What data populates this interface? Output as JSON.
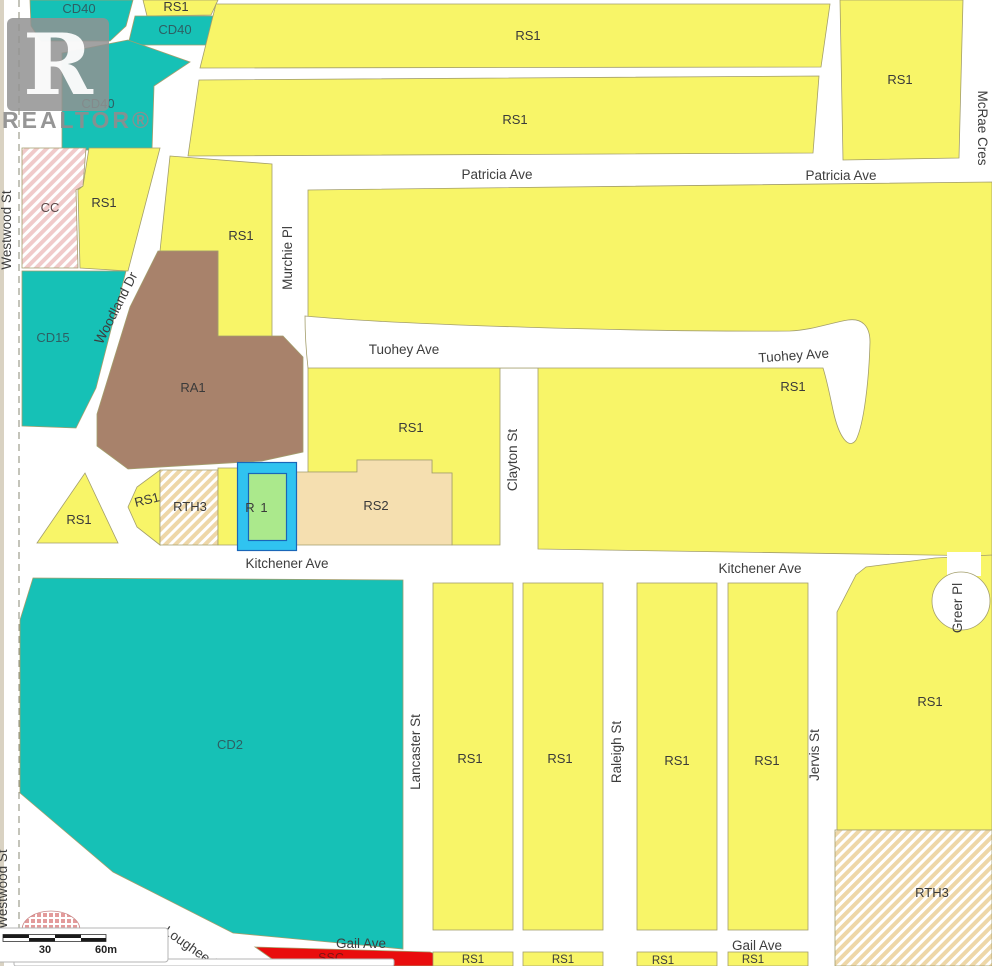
{
  "watermark": {
    "text": "REALTOR®",
    "letter": "R"
  },
  "map": {
    "zone_labels": [
      {
        "text": "CD40"
      },
      {
        "text": "RS1"
      },
      {
        "text": "CD40"
      },
      {
        "text": "CD40"
      },
      {
        "text": "CC"
      },
      {
        "text": "RS1"
      },
      {
        "text": "RS1"
      },
      {
        "text": "CD15"
      },
      {
        "text": "RA1"
      },
      {
        "text": "RS1"
      },
      {
        "text": "RS1"
      },
      {
        "text": "RS1"
      },
      {
        "text": "RS1"
      },
      {
        "text": "RS1"
      },
      {
        "text": "RS1"
      },
      {
        "text": "RS1"
      },
      {
        "text": "RTH3"
      },
      {
        "text": "R"
      },
      {
        "text": "1"
      },
      {
        "text": "RS2"
      },
      {
        "text": "CD2"
      },
      {
        "text": "RS1"
      },
      {
        "text": "RS1"
      },
      {
        "text": "RS1"
      },
      {
        "text": "RS1"
      },
      {
        "text": "RS1"
      },
      {
        "text": "RTH3"
      },
      {
        "text": "RS1"
      },
      {
        "text": "RS1"
      },
      {
        "text": "RS1"
      },
      {
        "text": "RS1"
      },
      {
        "text": "SSC"
      }
    ],
    "street_labels": [
      {
        "text": "Westwood St"
      },
      {
        "text": "Westwood St"
      },
      {
        "text": "Patricia Ave"
      },
      {
        "text": "Patricia Ave"
      },
      {
        "text": "McRae Cres"
      },
      {
        "text": "Murchie Pl"
      },
      {
        "text": "Woodland Dr"
      },
      {
        "text": "Tuohey Ave"
      },
      {
        "text": "Tuohey Ave"
      },
      {
        "text": "Clayton St"
      },
      {
        "text": "Kitchener Ave"
      },
      {
        "text": "Kitchener Ave"
      },
      {
        "text": "Lancaster St"
      },
      {
        "text": "Raleigh St"
      },
      {
        "text": "Jervis St"
      },
      {
        "text": "Greer Pl"
      },
      {
        "text": "Gail Ave"
      },
      {
        "text": "Gail Ave"
      },
      {
        "text": "Lougheed"
      }
    ],
    "scale_bar": {
      "label_mid": "30",
      "label_max": "60m"
    }
  },
  "colors": {
    "zone-yellow": "#f8f568",
    "zone-teal": "#16c1b6",
    "zone-brown": "#a8826b",
    "zone-wheat": "#f5dfb0",
    "zone-red": "#e90d0d",
    "hatch-tan": "#eed7a8",
    "hatch-pink": "#f0caca",
    "parcel-green": "#abe98c",
    "parcel-cyan": "#30c3f0",
    "parcel-outline": "#1a66b8",
    "outline": "#a39e6c",
    "street-text": "#3d3d3d",
    "zone-text": "#3a3a3a",
    "teal-text": "#2e5f63",
    "watermark": "#8e8e8e",
    "edge": "#d9d2c2"
  }
}
